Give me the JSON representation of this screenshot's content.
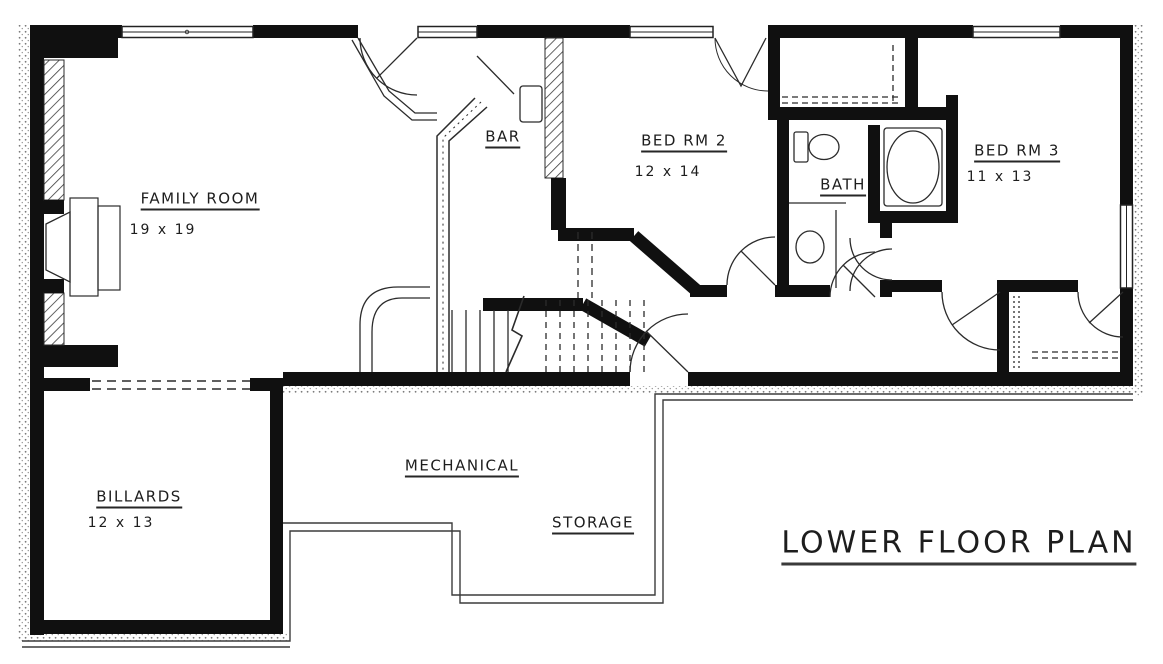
{
  "title": {
    "text": "LOWER FLOOR PLAN"
  },
  "rooms": [
    {
      "id": "family-room",
      "name": "FAMILY ROOM",
      "dims": "19 x 19"
    },
    {
      "id": "bar",
      "name": "BAR",
      "dims": ""
    },
    {
      "id": "bed-rm-2",
      "name": "BED RM 2",
      "dims": "12 x 14"
    },
    {
      "id": "bath",
      "name": "BATH",
      "dims": ""
    },
    {
      "id": "bed-rm-3",
      "name": "BED RM 3",
      "dims": "11 x 13"
    },
    {
      "id": "billards",
      "name": "BILLARDS",
      "dims": "12 x 13"
    },
    {
      "id": "mechanical",
      "name": "MECHANICAL",
      "dims": ""
    },
    {
      "id": "storage",
      "name": "STORAGE",
      "dims": ""
    }
  ],
  "drawing": {
    "ink": "#161616",
    "thin_line": "#2b2b2b",
    "foundation_line": "#3c3c3c",
    "background": "#ffffff",
    "fixture_icons": [
      "fireplace-icon",
      "bar-counter-icon",
      "stairs-icon",
      "toilet-icon",
      "sink-icon",
      "bathtub-icon",
      "closet-shelf-icon",
      "door-swing-icon",
      "window-icon"
    ]
  }
}
